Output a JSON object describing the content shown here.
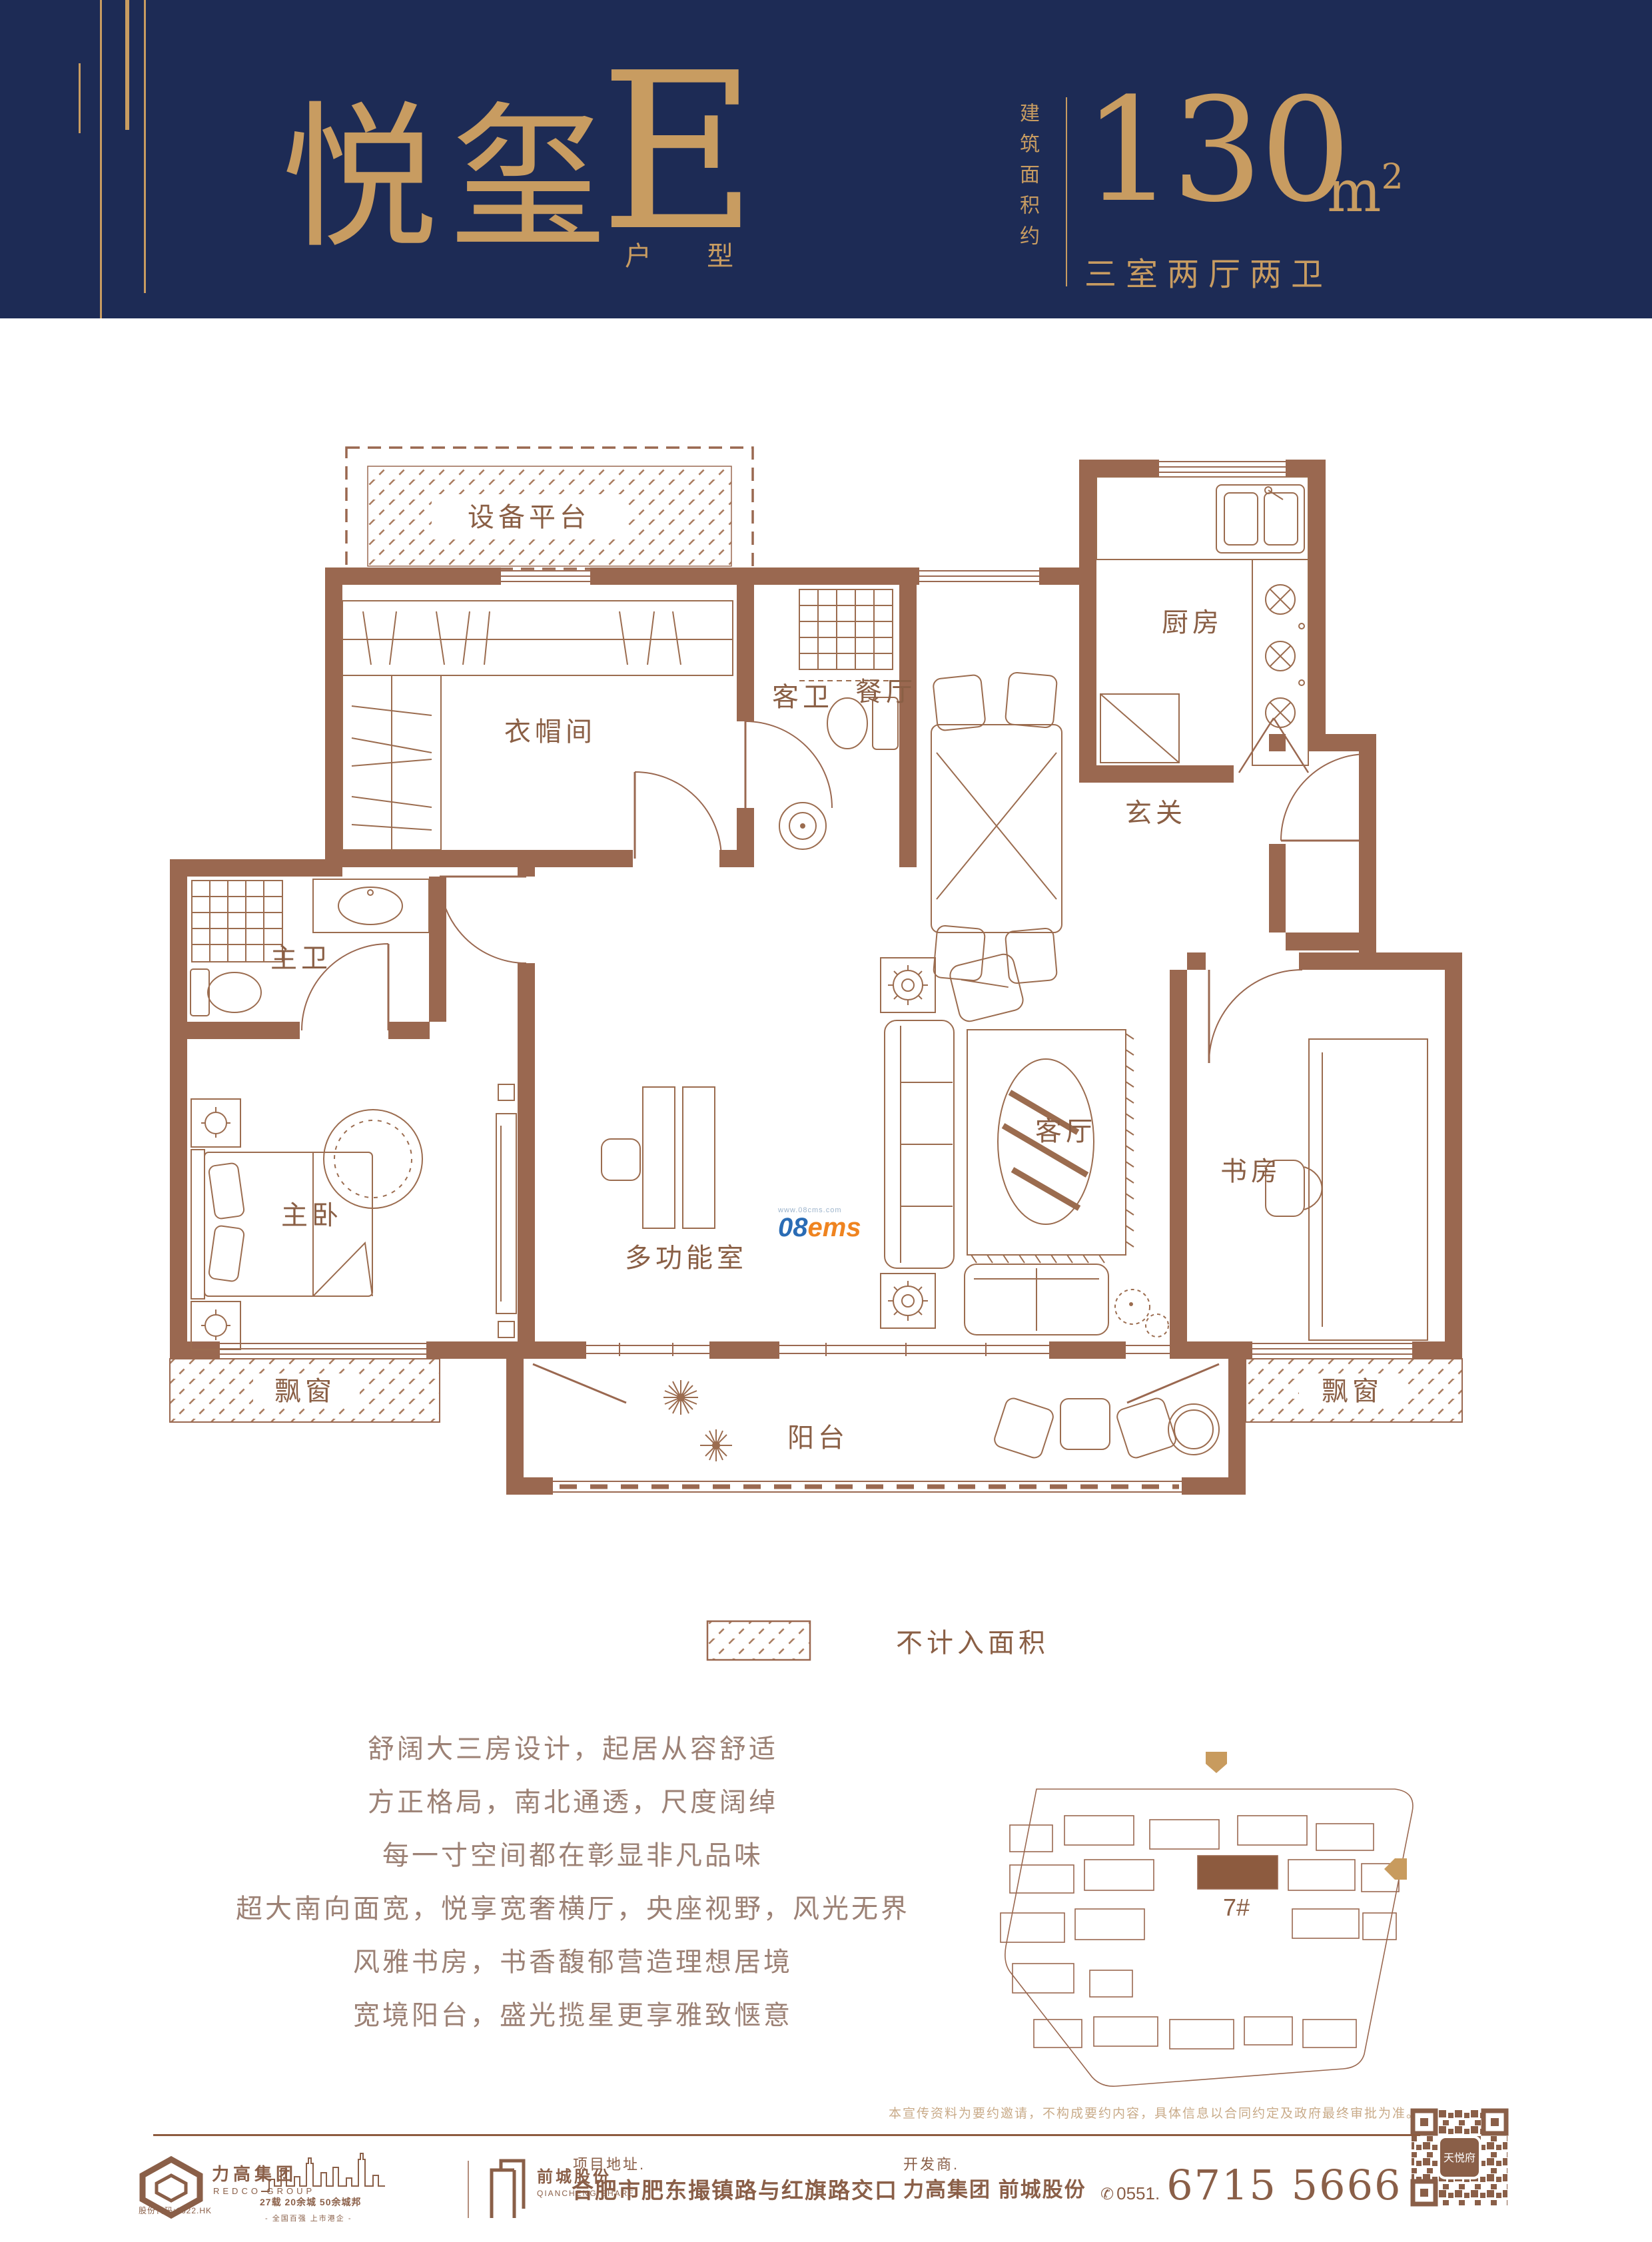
{
  "header": {
    "title_cn": "悦玺",
    "title_letter": "E",
    "title_sub": "户 型",
    "area_label": "建筑面积约",
    "area_value": "130",
    "area_unit": "m",
    "area_sup": "2",
    "layout": "三室两厅两卫",
    "accent_color": "#c89c61",
    "banner_color": "#1d2b55"
  },
  "floorplan": {
    "wall_color": "#9a6850",
    "rooms": [
      {
        "label": "设备平台"
      },
      {
        "label": "衣帽间"
      },
      {
        "label": "客卫"
      },
      {
        "label": "餐厅"
      },
      {
        "label": "厨房"
      },
      {
        "label": "玄关"
      },
      {
        "label": "主卫"
      },
      {
        "label": "主卧"
      },
      {
        "label": "多功能室"
      },
      {
        "label": "客厅"
      },
      {
        "label": "书房"
      },
      {
        "label": "飘窗"
      },
      {
        "label": "阳台"
      },
      {
        "label": "飘窗"
      }
    ],
    "legend": "不计入面积",
    "watermark_prefix": "08",
    "watermark_suffix": "ems",
    "watermark_url": "www.08cms.com"
  },
  "siteplan": {
    "building_label": "7#"
  },
  "marketing": {
    "lines": [
      "舒阔大三房设计，起居从容舒适",
      "方正格局，南北通透，尺度阔绰",
      "每一寸空间都在彰显非凡品味",
      "超大南向面宽，悦享宽奢横厅，央座视野，风光无界",
      "风雅书房，书香馥郁营造理想居境",
      "宽境阳台，盛光揽星更享雅致惬意"
    ]
  },
  "footer": {
    "disclaimer": "本宣传资料为要约邀请，不构成要约内容，具体信息以合同约定及政府最终审批为准。",
    "redco_name": "力高集团",
    "redco_en": "REDCO GROUP",
    "stock_code": "股份代码:1622.HK",
    "milestones": "27载 20余城 50余城邦",
    "milestones_sub": "- 全国百强 上市港企 -",
    "qiancheng_name": "前城股份",
    "qiancheng_en": "QIANCHENG SHARE",
    "address_label": "项目地址.",
    "address": "合肥市肥东撮镇路与红旗路交口",
    "developer_label": "开发商.",
    "developer": "力高集团  前城股份",
    "phone_area": "0551.",
    "phone": "6715 5666",
    "qr_label": "天悦府"
  }
}
